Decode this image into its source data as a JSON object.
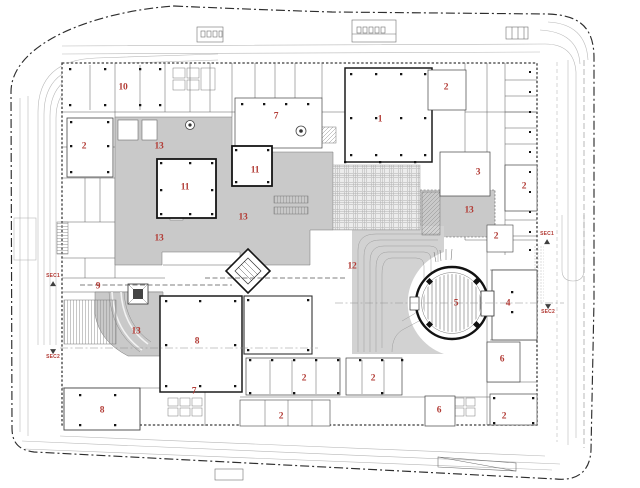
{
  "colors": {
    "label_red": "#b23b35",
    "poche_gray": "#c9c9c9",
    "contour_gray": "#d2d2d2",
    "wall_dark": "#2d2d2d",
    "road_gray": "#b5b5b5"
  },
  "room_labels": [
    {
      "text": "10",
      "x": 123,
      "y": 88
    },
    {
      "text": "2",
      "x": 84,
      "y": 147
    },
    {
      "text": "7",
      "x": 276,
      "y": 117
    },
    {
      "text": "1",
      "x": 380,
      "y": 120
    },
    {
      "text": "2",
      "x": 446,
      "y": 88
    },
    {
      "text": "13",
      "x": 159,
      "y": 147
    },
    {
      "text": "11",
      "x": 185,
      "y": 188
    },
    {
      "text": "11",
      "x": 255,
      "y": 171
    },
    {
      "text": "3",
      "x": 478,
      "y": 173
    },
    {
      "text": "2",
      "x": 524,
      "y": 187
    },
    {
      "text": "13",
      "x": 243,
      "y": 218
    },
    {
      "text": "13",
      "x": 469,
      "y": 211
    },
    {
      "text": "2",
      "x": 496,
      "y": 237
    },
    {
      "text": "13",
      "x": 159,
      "y": 239
    },
    {
      "text": "12",
      "x": 352,
      "y": 267
    },
    {
      "text": "9",
      "x": 98,
      "y": 287
    },
    {
      "text": "5",
      "x": 456,
      "y": 304
    },
    {
      "text": "4",
      "x": 508,
      "y": 304
    },
    {
      "text": "13",
      "x": 136,
      "y": 332
    },
    {
      "text": "8",
      "x": 197,
      "y": 342
    },
    {
      "text": "6",
      "x": 502,
      "y": 360
    },
    {
      "text": "2",
      "x": 304,
      "y": 379
    },
    {
      "text": "2",
      "x": 373,
      "y": 379
    },
    {
      "text": "8",
      "x": 102,
      "y": 411
    },
    {
      "text": "7",
      "x": 194,
      "y": 392
    },
    {
      "text": "6",
      "x": 439,
      "y": 411
    },
    {
      "text": "2",
      "x": 281,
      "y": 417
    },
    {
      "text": "2",
      "x": 504,
      "y": 417
    }
  ],
  "section_markers": [
    {
      "text": "SEC1",
      "x": 53,
      "y": 280,
      "arrow": "up"
    },
    {
      "text": "SEC2",
      "x": 53,
      "y": 355,
      "arrow": "down"
    },
    {
      "text": "SEC1",
      "x": 547,
      "y": 238,
      "arrow": "up"
    },
    {
      "text": "SEC2",
      "x": 548,
      "y": 310,
      "arrow": "down"
    }
  ]
}
